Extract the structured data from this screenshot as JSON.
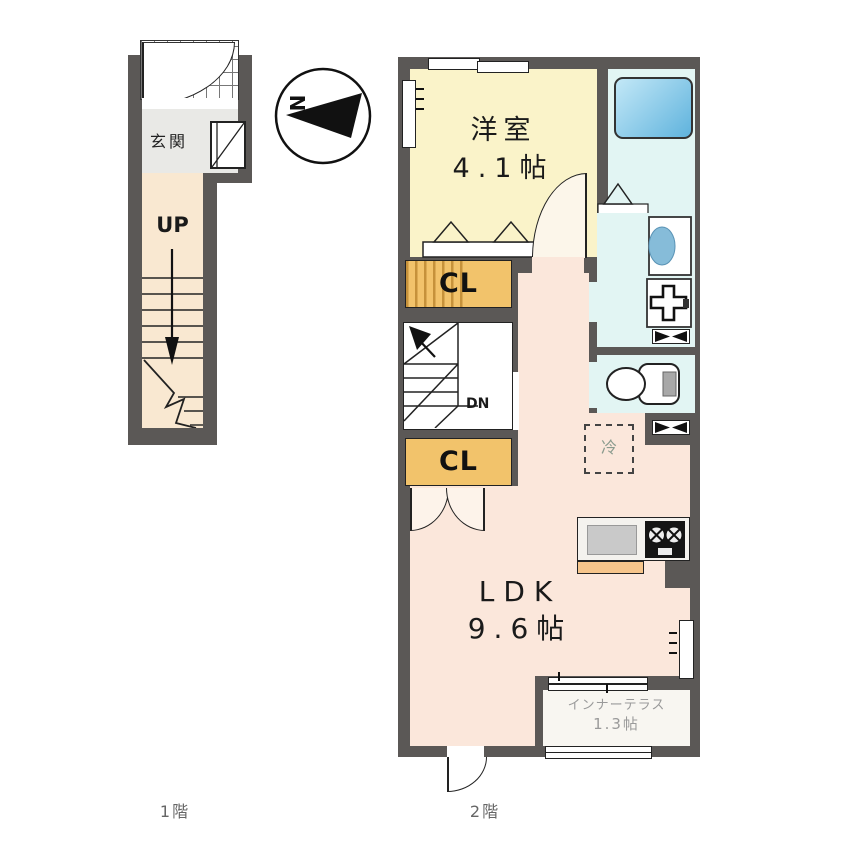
{
  "colors": {
    "wall": "#5b5856",
    "western_room_fill": "#faf3c9",
    "ldk_fill": "#fbe7db",
    "sanitary_fill": "#e2f5f3",
    "stairs_fill": "#f9e8d1",
    "entrance_fill": "#e9e9e6",
    "closet_fill": "#f2c36b",
    "counter_edge_fill": "#f6c58b",
    "bathtub_blue": "#5fb3dd",
    "basin_blue": "#86bcd9"
  },
  "floor1": {
    "caption": "1階",
    "entrance_label": "玄関",
    "up_label": "UP"
  },
  "compass": {
    "north_label": "N"
  },
  "floor2": {
    "caption": "2階",
    "western_room": {
      "name": "洋室",
      "area": "4.1帖"
    },
    "closet_upper_label": "CL",
    "closet_lower_label": "CL",
    "stairs_down_label": "DN",
    "refrigerator_label": "冷",
    "ldk": {
      "name": "LDK",
      "area": "9.6帖"
    },
    "inner_terrace": {
      "name": "インナーテラス",
      "area": "1.3帖"
    }
  }
}
